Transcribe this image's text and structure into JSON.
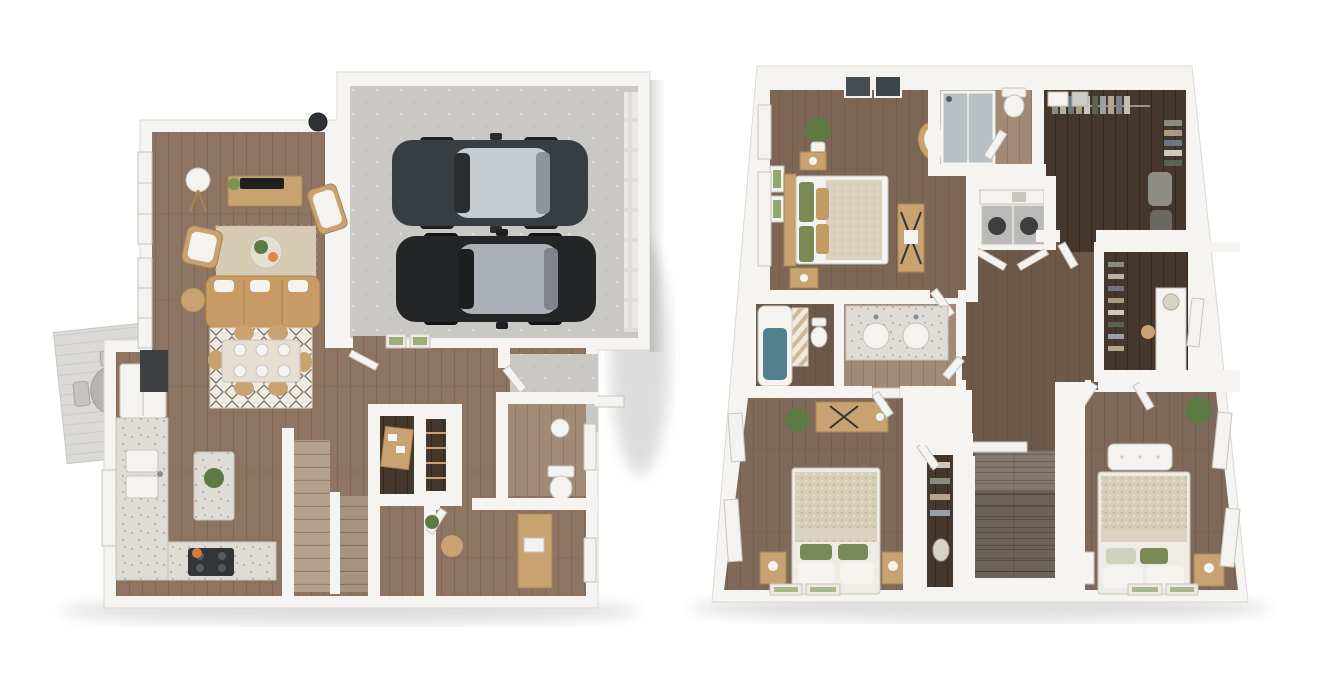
{
  "scene": {
    "type": "3d-floor-plan-rendering",
    "plans": [
      {
        "id": "first-floor",
        "position": "left",
        "rooms": [
          "living-room",
          "dining-area",
          "kitchen",
          "garage",
          "entry-hall",
          "staircase",
          "under-stair-den",
          "pantry",
          "powder-room",
          "office",
          "entry-porch",
          "outdoor-deck"
        ],
        "cars_in_garage": 2,
        "furnishings": [
          "sofa",
          "jute-rug",
          "coffee-table",
          "tv-console",
          "armchair",
          "floor-lamp",
          "dining-table",
          "dining-chairs",
          "kitchen-island",
          "fridge",
          "cooktop",
          "sink",
          "desk",
          "toilet",
          "deck-table"
        ]
      },
      {
        "id": "second-floor",
        "position": "right",
        "rooms": [
          "master-bedroom",
          "master-bathroom",
          "walk-in-closet",
          "laundry",
          "hallway",
          "hall-bathroom",
          "tub-room",
          "second-closet",
          "bedroom-2",
          "bedroom-3",
          "bedroom-closet",
          "staircase"
        ],
        "furnishings": [
          "master-bed",
          "nightstands",
          "vanity-desk",
          "rattan-chair",
          "shower",
          "double-vanity",
          "bathtub",
          "washer",
          "dryer",
          "bed",
          "dresser",
          "bench",
          "plants"
        ]
      }
    ]
  },
  "palette": {
    "bg": "#ffffff",
    "wall": "#f5f4f1",
    "wallEdge": "#dcd9d3",
    "woodLeft": "#8e7462",
    "woodMaster": "#7d6655",
    "woodHall": "#6d5949",
    "woodBed": "#7f695a",
    "woodDark": "#46372c",
    "woodLight": "#a18a76",
    "stairGray": "#8c8173",
    "plankSeam": "rgba(56,38,24,0.16)",
    "concrete": "#c9c8c5",
    "granite": "#dfdcd6",
    "deck": "#dbdad7",
    "fixtureWhite": "#f4f3f0",
    "fixtureEdge": "#c6c3bd",
    "cream": "#e6dfd1",
    "tanWood": "#c8a271",
    "tanWoodDark": "#a98550",
    "sofa": "#c89a66",
    "sofaDark": "#b08048",
    "rugJute": "#d7cbb4",
    "rugWhite": "#efeae1",
    "rugDiamond": "#6f6659",
    "plantGreen": "#5e7a44",
    "plantGreen2": "#78944f",
    "applianceDark": "#323436",
    "glassGray": "#b9c0c4",
    "tubTeal": "#53808e",
    "carBody1": "#383d42",
    "carBody2": "#232527",
    "carGlass": "#c7ccd1",
    "machineGray": "#b9b9b7",
    "pillowGreen": "#7c8a57",
    "pillowTan": "#c49a64",
    "blanketBeige": "#dbd2c2",
    "blanketKnit": "#d8cdb6",
    "stoveAccent": "#d97b3f"
  }
}
